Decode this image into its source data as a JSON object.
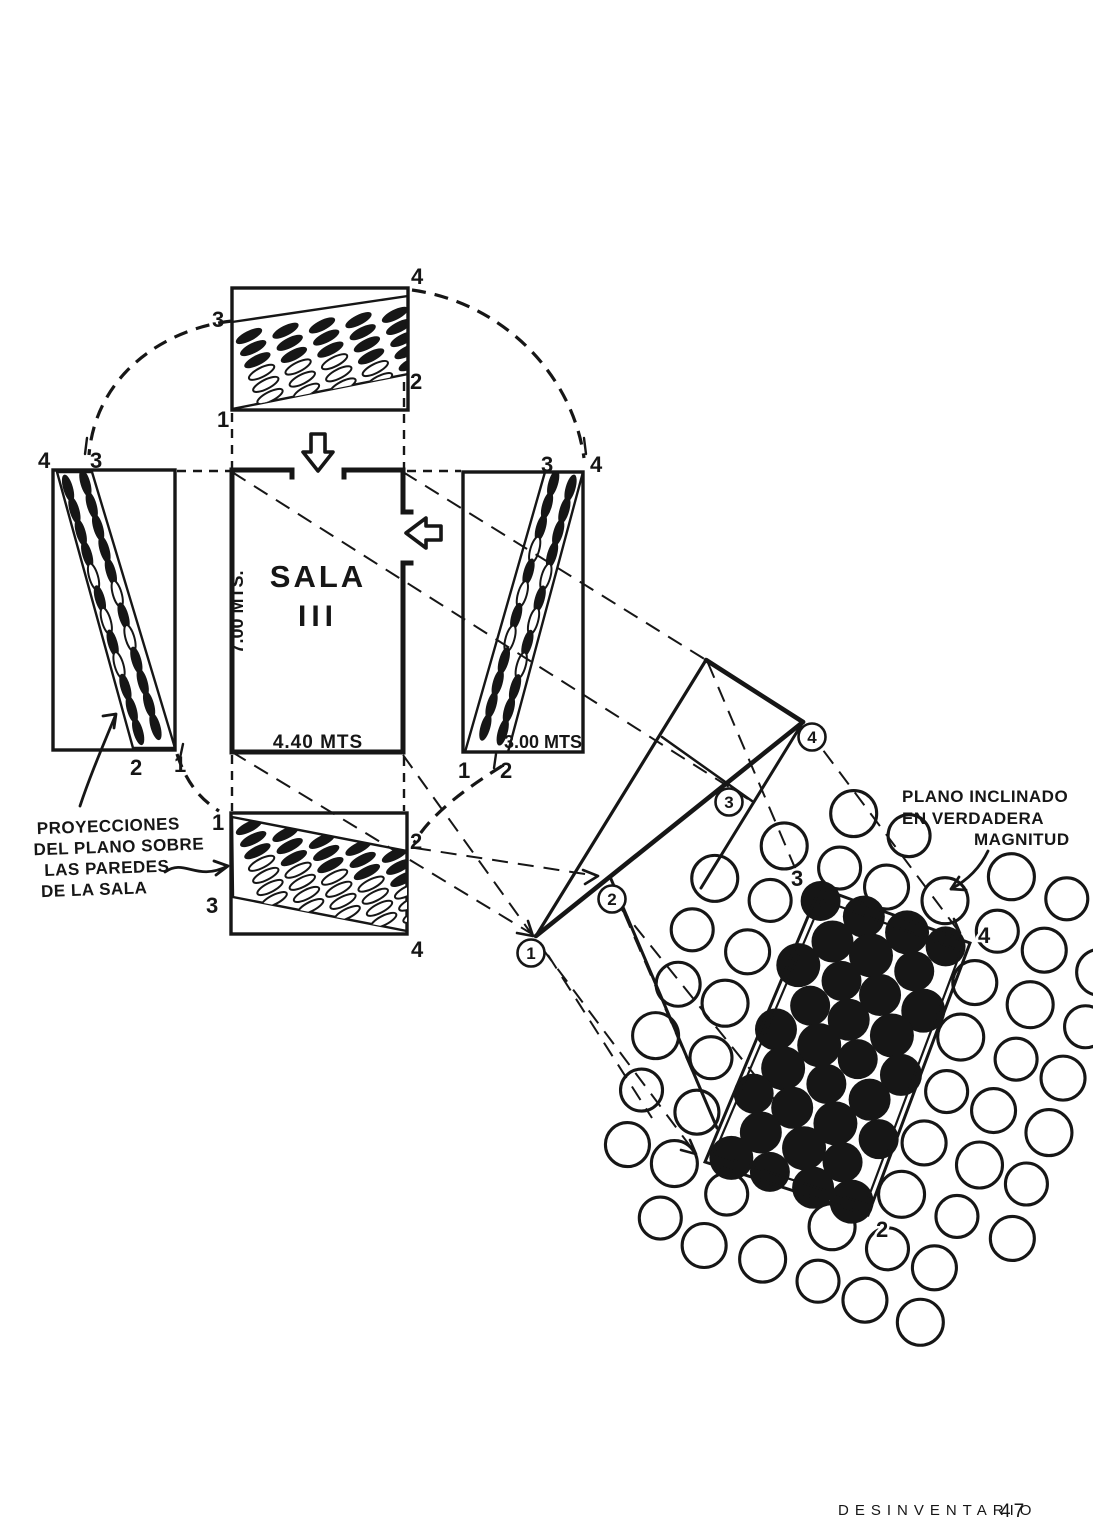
{
  "colors": {
    "ink": "#161616",
    "paper": "#ffffff",
    "footer_ink": "#2b2b2b"
  },
  "room": {
    "name": "SALA",
    "number": "III",
    "width_label": "4.40 MTS",
    "height_label": "7.00 MTS.",
    "depth_label": "3.00 MTS"
  },
  "notes": {
    "projections": {
      "line1": "PROYECCIONES",
      "line2": "DEL PLANO SOBRE",
      "line3": "LAS PAREDES",
      "line4": "DE LA SALA"
    },
    "magnitude": {
      "line1": "PLANO INCLINADO",
      "line2": "EN VERDADERA",
      "line3": "MAGNITUD"
    }
  },
  "walls": {
    "top": {
      "tl": "3",
      "tr": "4",
      "br": "2",
      "bl": "1"
    },
    "left": {
      "tl": "4",
      "tr": "3",
      "bl": "2",
      "br": "1"
    },
    "right": {
      "tl": "3",
      "tr": "4",
      "bl": "1",
      "br": "2"
    },
    "bottom": {
      "tl": "1",
      "tr": "2",
      "ml": "3",
      "br": "4"
    }
  },
  "fold": {
    "v1": "1",
    "v2": "2",
    "v3": "3",
    "v4": "4"
  },
  "plane": {
    "top": "3",
    "right": "4",
    "bottom": "2"
  },
  "footer": {
    "label": "DESINVENTARIO",
    "page": "47"
  }
}
